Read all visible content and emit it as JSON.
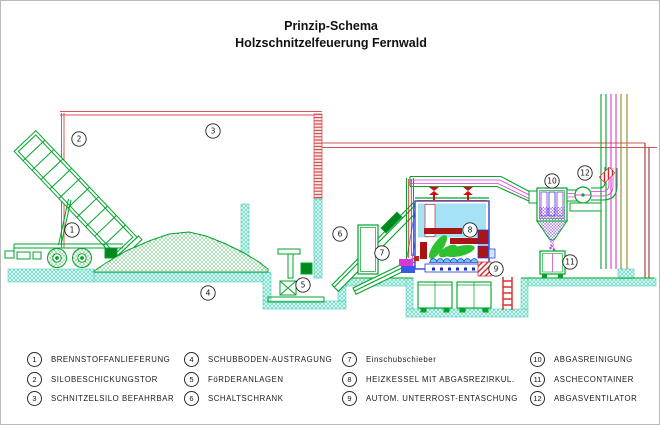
{
  "title": {
    "line1": "Prinzip-Schema",
    "line2": "Holzschnitzelfeuerung Fernwald"
  },
  "legend": {
    "items": [
      {
        "num": "1",
        "label": "BRENNSTOFFANLIEFERUNG"
      },
      {
        "num": "2",
        "label": "SILOBESCHICKUNGSTOR"
      },
      {
        "num": "3",
        "label": "SCHNITZELSILO BEFAHRBAR"
      },
      {
        "num": "4",
        "label": "SCHUBBODEN-AUSTRAGUNG"
      },
      {
        "num": "5",
        "label": "FöRDERANLAGEN"
      },
      {
        "num": "6",
        "label": "SCHALTSCHRANK"
      },
      {
        "num": "7",
        "label": "Einschubschieber"
      },
      {
        "num": "8",
        "label": "HEIZKESSEL MIT ABGASREZIRKUL."
      },
      {
        "num": "9",
        "label": "AUTOM. UNTERROST-ENTASCHUNG"
      },
      {
        "num": "10",
        "label": "ABGASREINIGUNG"
      },
      {
        "num": "11",
        "label": "ASCHECONTAINER"
      },
      {
        "num": "12",
        "label": "ABGASVENTILATOR"
      }
    ]
  },
  "colors": {
    "machinery_green": "#00A428",
    "building_red": "#D85555",
    "boiler_blue": "#2038D0",
    "water_cyan": "#A5E2F5",
    "hot_dark_red": "#AA1414",
    "magenta": "#D838D8",
    "ash_purple": "#7A2FE0",
    "floor_teal": "#55CCBA",
    "chimney_olive": "#8A8A20"
  }
}
